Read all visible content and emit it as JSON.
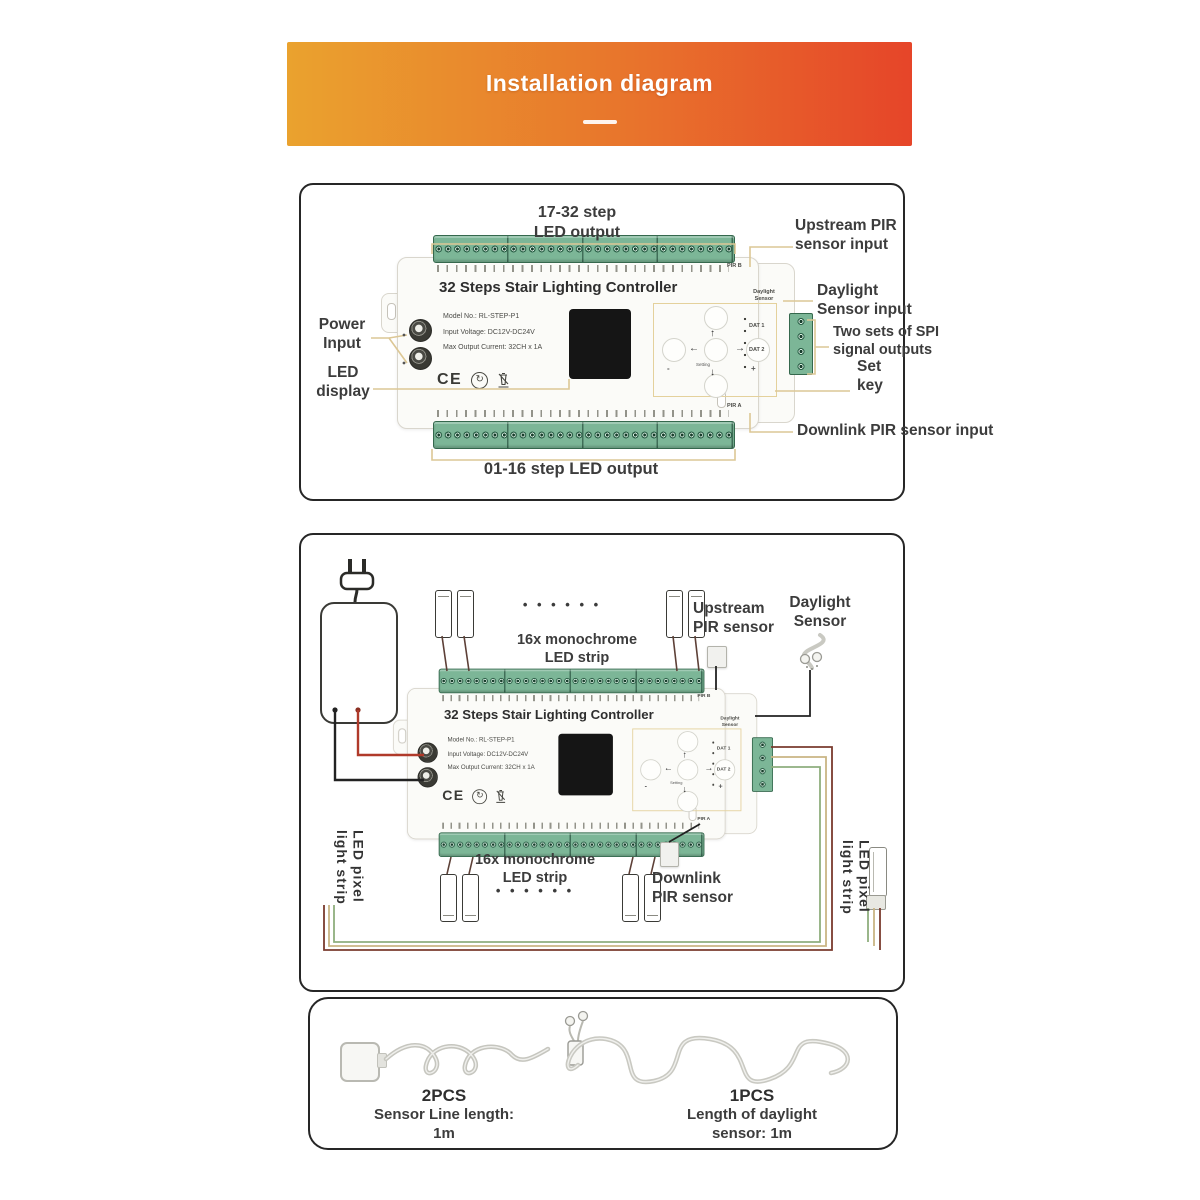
{
  "banner": {
    "title": "Installation diagram"
  },
  "controller": {
    "title": "32 Steps Stair Lighting Controller",
    "model_no": "Model No.: RL-STEP-P1",
    "input_voltage": "Input Voltage: DC12V-DC24V",
    "max_output": "Max Output Current: 32CH x 1A",
    "ce_mark": "CE",
    "pir_b": "PIR B",
    "pir_a": "PIR A",
    "daylight_port_l1": "Daylight",
    "daylight_port_l2": "Sensor",
    "dat1": "DAT 1",
    "dat2": "DAT 2",
    "setting_key": "Setting",
    "minus": "-",
    "plus": "+"
  },
  "diagram1": {
    "top_output_l1": "17-32 step",
    "top_output_l2": "LED output",
    "upstream_l1": "Upstream PIR",
    "upstream_l2": "sensor input",
    "daylight_l1": "Daylight",
    "daylight_l2": "Sensor input",
    "spi_l1": "Two sets of SPI",
    "spi_l2": "signal outputs",
    "set_key_l1": "Set",
    "set_key_l2": "key",
    "downlink": "Downlink PIR sensor input",
    "power_l1": "Power",
    "power_l2": "Input",
    "led_display_l1": "LED",
    "led_display_l2": "display",
    "bottom_output": "01-16 step LED output"
  },
  "diagram2": {
    "dots_top": "• • • • • •",
    "dots_bottom": "• • • • • •",
    "strip_top_l1": "16x monochrome",
    "strip_top_l2": "LED strip",
    "strip_bottom_l1": "16x monochrome",
    "strip_bottom_l2": "LED strip",
    "upstream_l1": "Upstream",
    "upstream_l2": "PIR sensor",
    "daylight_l1": "Daylight",
    "daylight_l2": "Sensor",
    "downlink_l1": "Downlink",
    "downlink_l2": "PIR sensor",
    "pixel_left_l1": "LED pixel",
    "pixel_left_l2": "light strip",
    "pixel_right_l1": "LED pixel",
    "pixel_right_l2": "light strip"
  },
  "accessories": {
    "left_qty": "2PCS",
    "left_l1": "Sensor Line length:",
    "left_l2": "1m",
    "right_qty": "1PCS",
    "right_l1": "Length of daylight",
    "right_l2": "sensor: 1m"
  },
  "colors": {
    "banner_start": "#eaa22e",
    "banner_end": "#e64529",
    "callout_gold": "#dcc795",
    "terminal_green": "#7cb697",
    "wire_red": "#b03a2a",
    "wire_black": "#222222",
    "wire_brown": "#7a3b2e",
    "wire_tan": "#c9b584",
    "wire_green": "#8fae7e"
  }
}
